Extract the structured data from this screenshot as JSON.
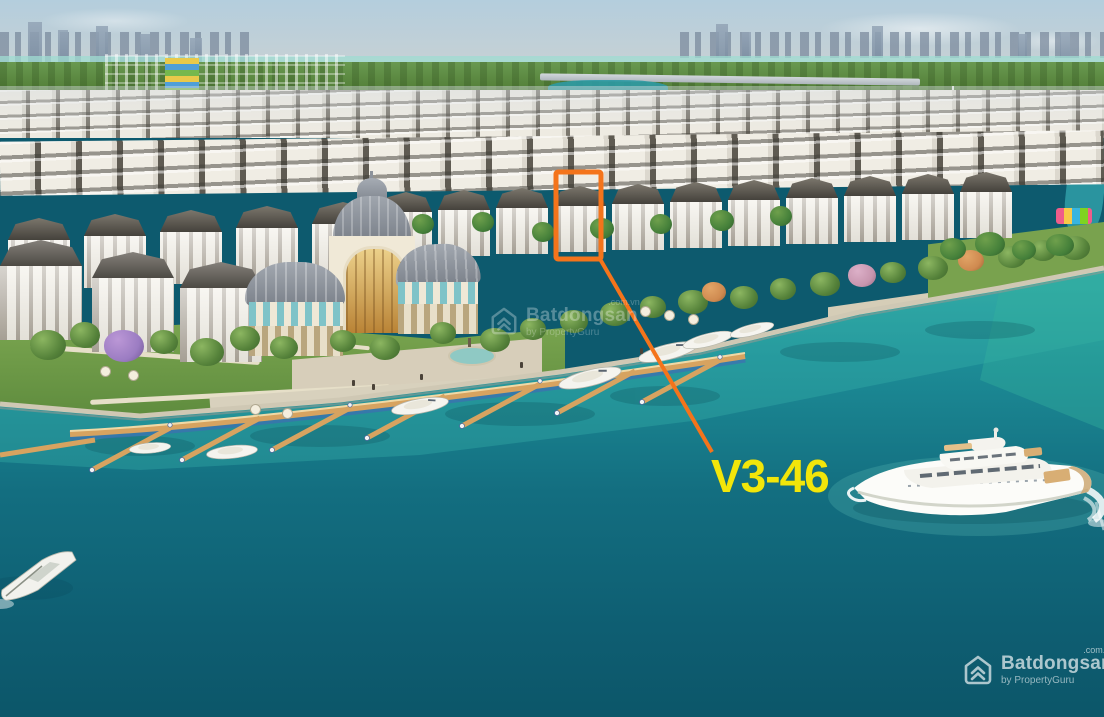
{
  "annotation": {
    "unit_label": "V3-46",
    "highlight_color": "#F4741B",
    "label_color": "#F2E60A"
  },
  "watermarks": {
    "corner": {
      "brand": "Batdongsan",
      "domain": ".com.vn",
      "byline": "by PropertyGuru",
      "logo_icon": "batdongsan-logo-icon"
    },
    "center": {
      "brand": "Batdongsan",
      "domain": ".com.vn",
      "byline": "by PropertyGuru",
      "logo_icon": "batdongsan-logo-icon"
    }
  },
  "palette": {
    "water_deep": "#0D5A6E",
    "water_shallow": "#2FA9A4",
    "annotation_orange": "#F4741B",
    "label_yellow": "#F2E60A"
  }
}
